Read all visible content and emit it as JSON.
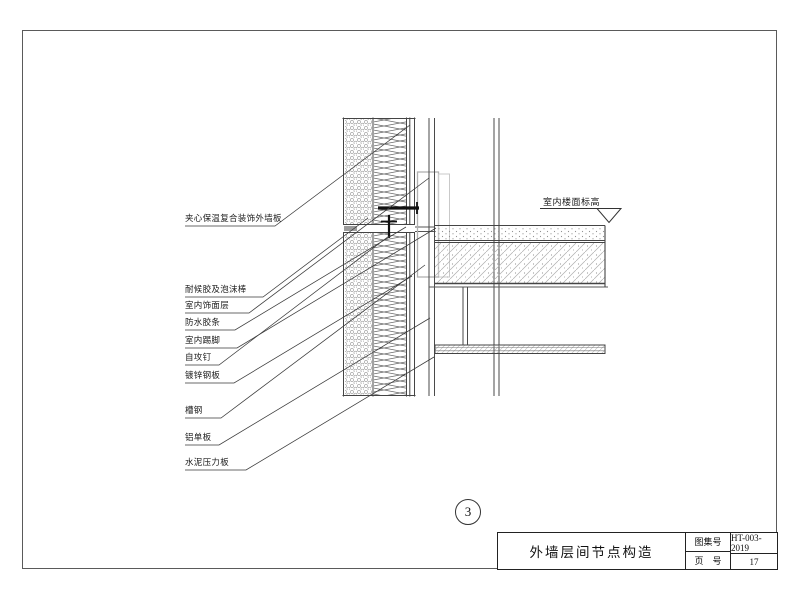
{
  "drawing": {
    "detail_number": "3",
    "labels_left": [
      "夹心保温复合装饰外墙板",
      "耐候胶及泡沫棒",
      "室内饰面层",
      "防水胶条",
      "室内踢脚",
      "自攻钉",
      "镀锌钢板",
      "槽钢",
      "铝单板",
      "水泥压力板"
    ],
    "elevation_label": "室内楼面标高"
  },
  "title_block": {
    "title": "外墙层间节点构造",
    "atlas_no_label": "图集号",
    "atlas_no_value": "HT-003-2019",
    "page_no_label": "页　号",
    "page_no_value": "17"
  },
  "colors": {
    "line_dark": "#333333",
    "line_mid": "#555555",
    "hatch_light": "#a8a8a8",
    "bracket_gray": "#b0b0b0",
    "paper": "#ffffff"
  }
}
